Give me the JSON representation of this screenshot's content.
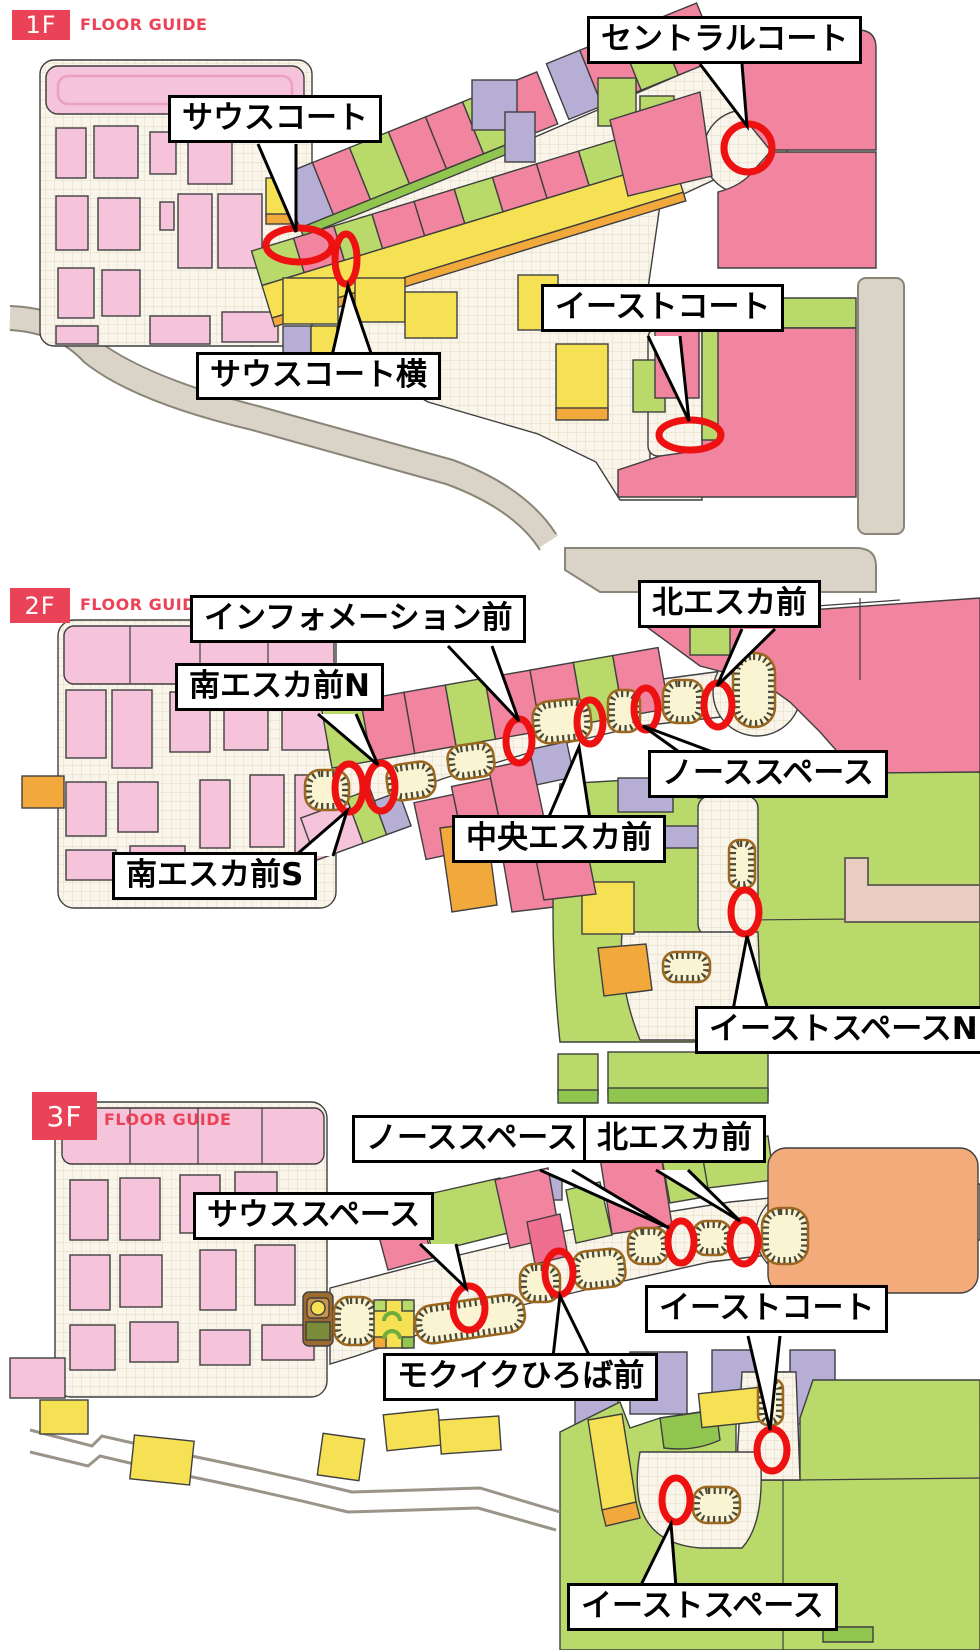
{
  "floors": [
    {
      "badge": "1F",
      "guide": "FLOOR GUIDE",
      "callouts": [
        {
          "id": "south-court",
          "text": "サウスコート"
        },
        {
          "id": "central-court",
          "text": "セントラルコート"
        },
        {
          "id": "east-court",
          "text": "イーストコート"
        },
        {
          "id": "south-court-side",
          "text": "サウスコート横"
        }
      ]
    },
    {
      "badge": "2F",
      "guide": "FLOOR GUIDE",
      "callouts": [
        {
          "id": "information-front",
          "text": "インフォメーション前"
        },
        {
          "id": "north-escalator-front",
          "text": "北エスカ前"
        },
        {
          "id": "south-escalator-front-n",
          "text": "南エスカ前N"
        },
        {
          "id": "north-space",
          "text": "ノーススペース"
        },
        {
          "id": "central-escalator-front",
          "text": "中央エスカ前"
        },
        {
          "id": "south-escalator-front-s",
          "text": "南エスカ前S"
        },
        {
          "id": "east-space-n",
          "text": "イーストスペースN"
        }
      ]
    },
    {
      "badge": "3F",
      "guide": "FLOOR GUIDE",
      "callouts": [
        {
          "id": "north-space",
          "text": "ノーススペース"
        },
        {
          "id": "north-escalator-front",
          "text": "北エスカ前"
        },
        {
          "id": "south-space",
          "text": "サウススペース"
        },
        {
          "id": "east-court",
          "text": "イーストコート"
        },
        {
          "id": "mokuiku-hiroba-front",
          "text": "モクイクひろば前"
        },
        {
          "id": "east-space",
          "text": "イーストスペース"
        }
      ]
    }
  ],
  "colors": {
    "accent_red": "#ea4256",
    "marker_red": "#ee1111",
    "shop_pink": "#f1849f",
    "shop_pink_light": "#f5c3da",
    "shop_green": "#b9d96a",
    "shop_yellow": "#f6e155",
    "shop_orange": "#f2a93c",
    "shop_lavender": "#b7aed6",
    "shop_peach": "#f4ab7c",
    "walkway_cream": "#f9f5ea",
    "road_gray": "#d9d4c7"
  }
}
